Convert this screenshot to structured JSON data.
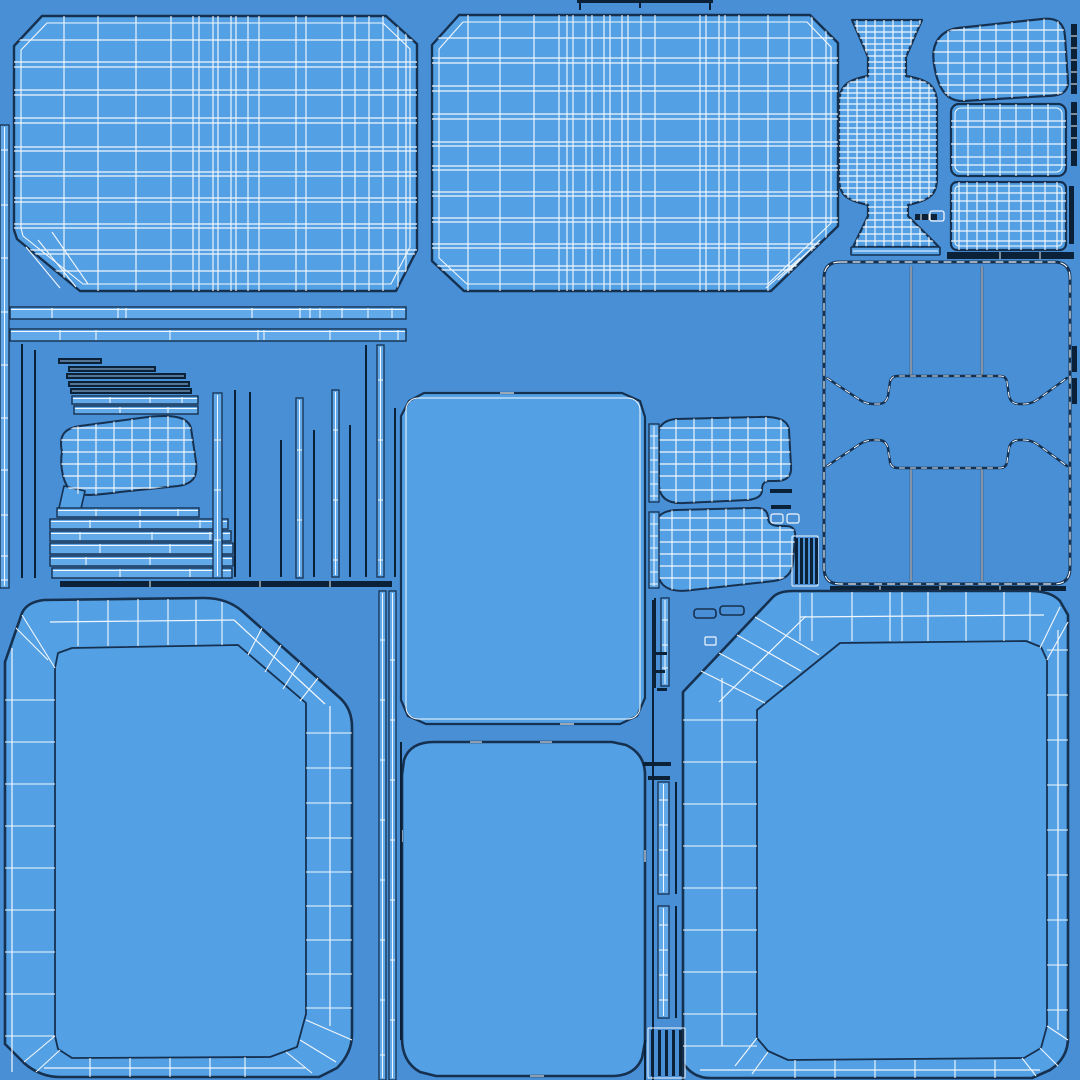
{
  "meta": {
    "type": "uv-texture-wireframe-sheet",
    "description": "Blueprint-style UV wireframe texture sheet of a 3D furniture/seat model",
    "canvas": {
      "width": 1080,
      "height": 1080
    }
  },
  "palette": {
    "background": "#488FD6",
    "island_fill": "#53A0E5",
    "strip_fill": "#61A9E9",
    "outline_dark": "#16304F",
    "outline_black": "#0B2137",
    "wireframe_white": "#F2F7FC",
    "stair_light": "#9CC8EF"
  },
  "islands": [
    {
      "id": "panel-top-left",
      "label": "gridded cushion panel top left"
    },
    {
      "id": "panel-top-center",
      "label": "gridded cushion panel top center"
    },
    {
      "id": "spool-pedestal",
      "label": "pedestal spool island"
    },
    {
      "id": "blob-top-right",
      "label": "corner blob island top right"
    },
    {
      "id": "grid-rect-upper-right",
      "label": "gridded rectangle upper right"
    },
    {
      "id": "grid-rect-right",
      "label": "dense gridded rectangle right"
    },
    {
      "id": "frame-square-right",
      "label": "square frame island with waist bands"
    },
    {
      "id": "strip-cluster-left",
      "label": "cluster of trim strips and bars"
    },
    {
      "id": "plain-panel-center",
      "label": "plain rounded panel center"
    },
    {
      "id": "cushion-blob-left",
      "label": "small cushion side blob left"
    },
    {
      "id": "cushion-blob-mid-upper",
      "label": "cushion side blob middle upper"
    },
    {
      "id": "cushion-blob-mid-lower",
      "label": "cushion side blob middle lower"
    },
    {
      "id": "panel-bottom-left",
      "label": "framed band panel bottom left"
    },
    {
      "id": "panel-bottom-center",
      "label": "plain rounded panel bottom center"
    },
    {
      "id": "panel-bottom-right",
      "label": "framed band panel bottom right"
    },
    {
      "id": "divider-strips-center",
      "label": "vertical divider strips"
    },
    {
      "id": "small-parts",
      "label": "small hardware parts"
    },
    {
      "id": "edge-strips-right",
      "label": "thin edge strips right"
    },
    {
      "id": "top-edge-strip",
      "label": "cut-off strip at top edge"
    }
  ]
}
